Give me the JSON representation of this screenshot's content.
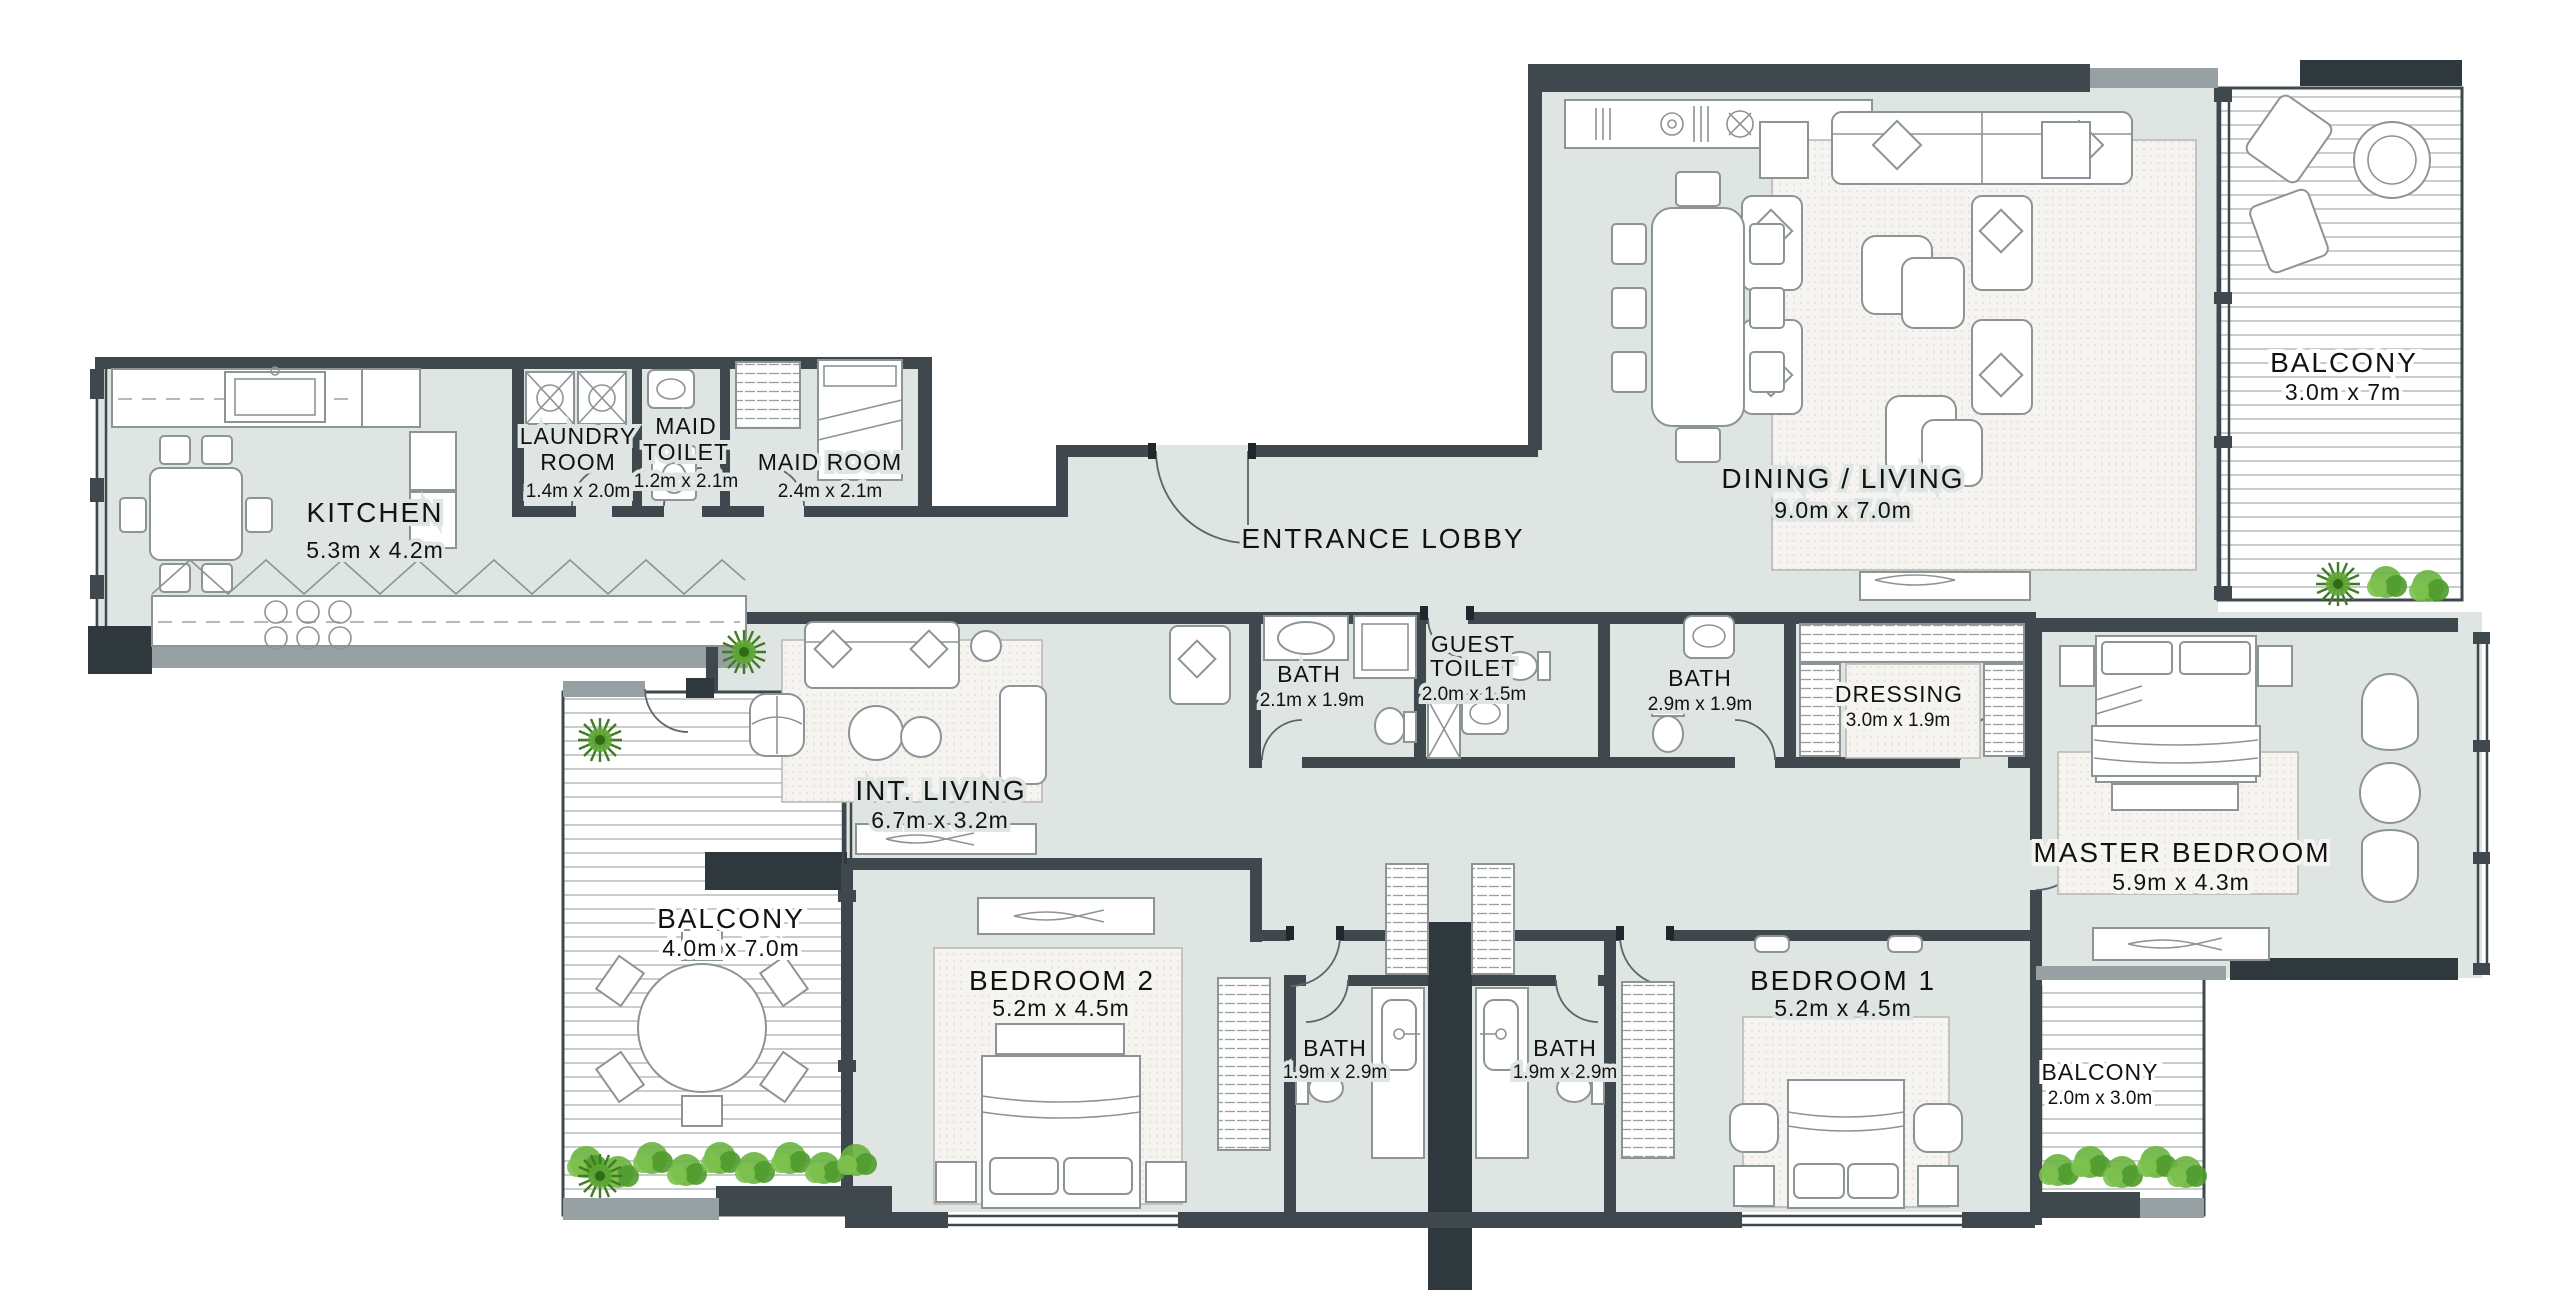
{
  "plan": {
    "type": "apartment-floor-plan",
    "colors": {
      "wall": "#3f484c",
      "wall_light": "#97a0a2",
      "floor": "#dfe5e3",
      "deck_line": "#b6bcba",
      "rug": "#f6f4f1",
      "plant_green": "#5fa835",
      "plant_dark": "#3f7d20",
      "text": "#121212"
    },
    "rooms": {
      "kitchen": {
        "name": "KITCHEN",
        "dims": "5.3m x 4.2m"
      },
      "laundry": {
        "line1": "LAUNDRY",
        "line2": "ROOM",
        "dims": "1.4m x 2.0m"
      },
      "maid_toilet": {
        "line1": "MAID",
        "line2": "TOILET",
        "dims": "1.2m x 2.1m"
      },
      "maid_room": {
        "name": "MAID ROOM",
        "dims": "2.4m x 2.1m"
      },
      "entrance_lobby": {
        "name": "ENTRANCE LOBBY"
      },
      "dining_living": {
        "name": "DINING / LIVING",
        "dims": "9.0m x 7.0m"
      },
      "balcony_top": {
        "name": "BALCONY",
        "dims": "3.0m x 7m"
      },
      "bath_a": {
        "name": "BATH",
        "dims": "2.1m x 1.9m"
      },
      "guest_toilet": {
        "line1": "GUEST",
        "line2": "TOILET",
        "dims": "2.0m x 1.5m"
      },
      "bath_b": {
        "name": "BATH",
        "dims": "2.9m x 1.9m"
      },
      "dressing": {
        "name": "DRESSING",
        "dims": "3.0m x 1.9m"
      },
      "master_bedroom": {
        "name": "MASTER BEDROOM",
        "dims": "5.9m x 4.3m"
      },
      "int_living": {
        "name": "INT. LIVING",
        "dims": "6.7m x 3.2m"
      },
      "balcony_left": {
        "name": "BALCONY",
        "dims": "4.0m x 7.0m"
      },
      "bedroom2": {
        "name": "BEDROOM 2",
        "dims": "5.2m x 4.5m"
      },
      "bath_c": {
        "name": "BATH",
        "dims": "1.9m x 2.9m"
      },
      "bath_d": {
        "name": "BATH",
        "dims": "1.9m x 2.9m"
      },
      "bedroom1": {
        "name": "BEDROOM 1",
        "dims": "5.2m x 4.5m"
      },
      "balcony_right": {
        "name": "BALCONY",
        "dims": "2.0m x 3.0m"
      }
    }
  }
}
